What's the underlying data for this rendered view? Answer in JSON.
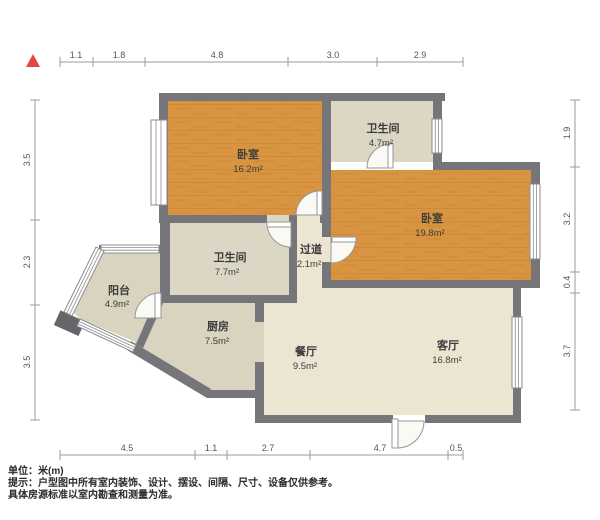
{
  "rooms": [
    {
      "id": "bedroom-1",
      "name": "卧室",
      "area": "16.2m²"
    },
    {
      "id": "bathroom-top",
      "name": "卫生间",
      "area": "4.7m²"
    },
    {
      "id": "bedroom-2",
      "name": "卧室",
      "area": "19.8m²"
    },
    {
      "id": "bathroom-mid",
      "name": "卫生间",
      "area": "7.7m²"
    },
    {
      "id": "hallway",
      "name": "过道",
      "area": "2.1m²"
    },
    {
      "id": "balcony",
      "name": "阳台",
      "area": "4.9m²"
    },
    {
      "id": "kitchen",
      "name": "厨房",
      "area": "7.5m²"
    },
    {
      "id": "dining",
      "name": "餐厅",
      "area": "9.5m²"
    },
    {
      "id": "living",
      "name": "客厅",
      "area": "16.8m²"
    }
  ],
  "dimensions": {
    "unit": "m",
    "top": [
      "1.1",
      "1.8",
      "4.8",
      "3.0",
      "2.9"
    ],
    "left": [
      "3.5",
      "2.3",
      "3.5"
    ],
    "right": [
      "1.9",
      "3.2",
      "0.4",
      "3.7"
    ],
    "bottom": [
      "4.5",
      "1.1",
      "2.7",
      "4.7",
      "0.5"
    ]
  },
  "footer": {
    "unit_label": "单位：米(m)",
    "note_line1": "提示：户型图中所有室内装饰、设计、摆设、间隔、尺寸、设备仅供参考。",
    "note_line2": "具体房源标准以室内勘查和测量为准。"
  },
  "colors": {
    "wall": "#76757A",
    "wood_floor": "#D89440",
    "tile_floor": "#DCD7C5",
    "living_floor": "#ECE5D2",
    "kitchen_floor": "#D8D4BF",
    "north_arrow": "#E0493F",
    "dim_line": "#9B9B9B"
  }
}
